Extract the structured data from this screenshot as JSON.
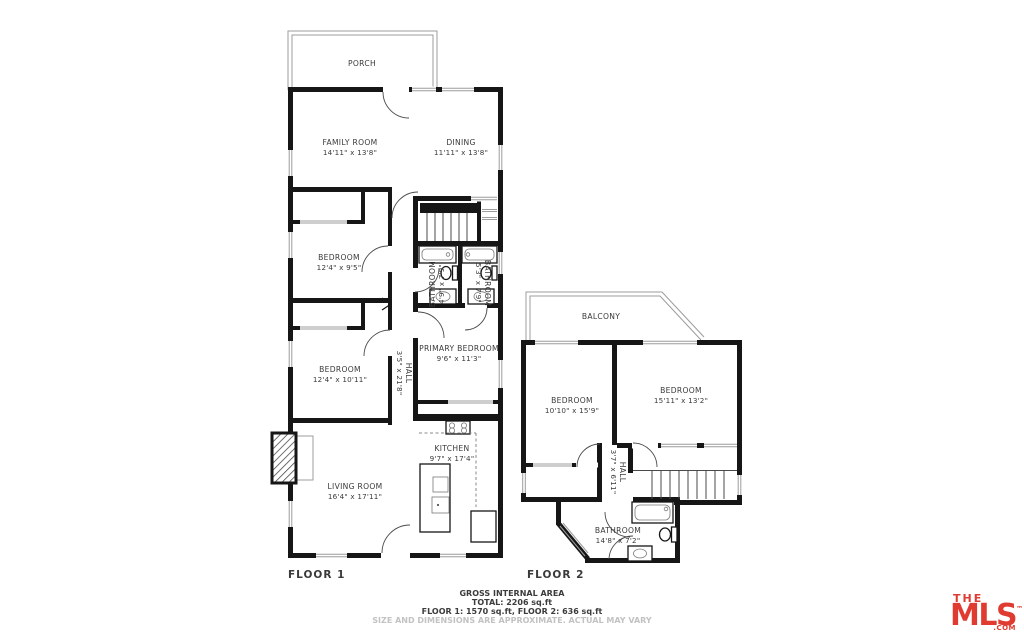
{
  "floor1": {
    "label": "FLOOR 1",
    "rooms": [
      {
        "name": "PORCH",
        "dims": ""
      },
      {
        "name": "FAMILY ROOM",
        "dims": "14'11\" x 13'8\""
      },
      {
        "name": "DINING",
        "dims": "11'11\" x 13'8\""
      },
      {
        "name": "BEDROOM",
        "dims": "12'4\" x 9'5\""
      },
      {
        "name": "BATHROOM",
        "dims": "4'9\" x 7'9\""
      },
      {
        "name": "BATHROOM",
        "dims": "5'3\" x 7'9\""
      },
      {
        "name": "HALL",
        "dims": "3'5\" x 21'8\""
      },
      {
        "name": "BEDROOM",
        "dims": "12'4\" x 10'11\""
      },
      {
        "name": "PRIMARY BEDROOM",
        "dims": "9'6\" x 11'3\""
      },
      {
        "name": "KITCHEN",
        "dims": "9'7\" x 17'4\""
      },
      {
        "name": "LIVING ROOM",
        "dims": "16'4\" x 17'11\""
      }
    ]
  },
  "floor2": {
    "label": "FLOOR 2",
    "rooms": [
      {
        "name": "BALCONY",
        "dims": ""
      },
      {
        "name": "BEDROOM",
        "dims": "10'10\" x 15'9\""
      },
      {
        "name": "BEDROOM",
        "dims": "15'11\" x 13'2\""
      },
      {
        "name": "HALL",
        "dims": "3'7\" x 6'11\""
      },
      {
        "name": "BATHROOM",
        "dims": "14'8\" x 7'2\""
      }
    ]
  },
  "footer": {
    "title": "GROSS INTERNAL AREA",
    "total": "TOTAL: 2206 sq.ft",
    "floors": "FLOOR 1: 1570 sq.ft, FLOOR 2: 636 sq.ft",
    "disclaimer": "SIZE AND DIMENSIONS ARE APPROXIMATE. ACTUAL MAY VARY"
  },
  "logo": {
    "the": "THE",
    "mls": "MLS",
    "com": ".COM",
    "tm": "™"
  },
  "colors": {
    "wall": "#161616",
    "text": "#3a3a3a",
    "light_line": "#9c9c9c",
    "logo_red": "#e03b30",
    "disclaimer": "#c2c2c2"
  }
}
